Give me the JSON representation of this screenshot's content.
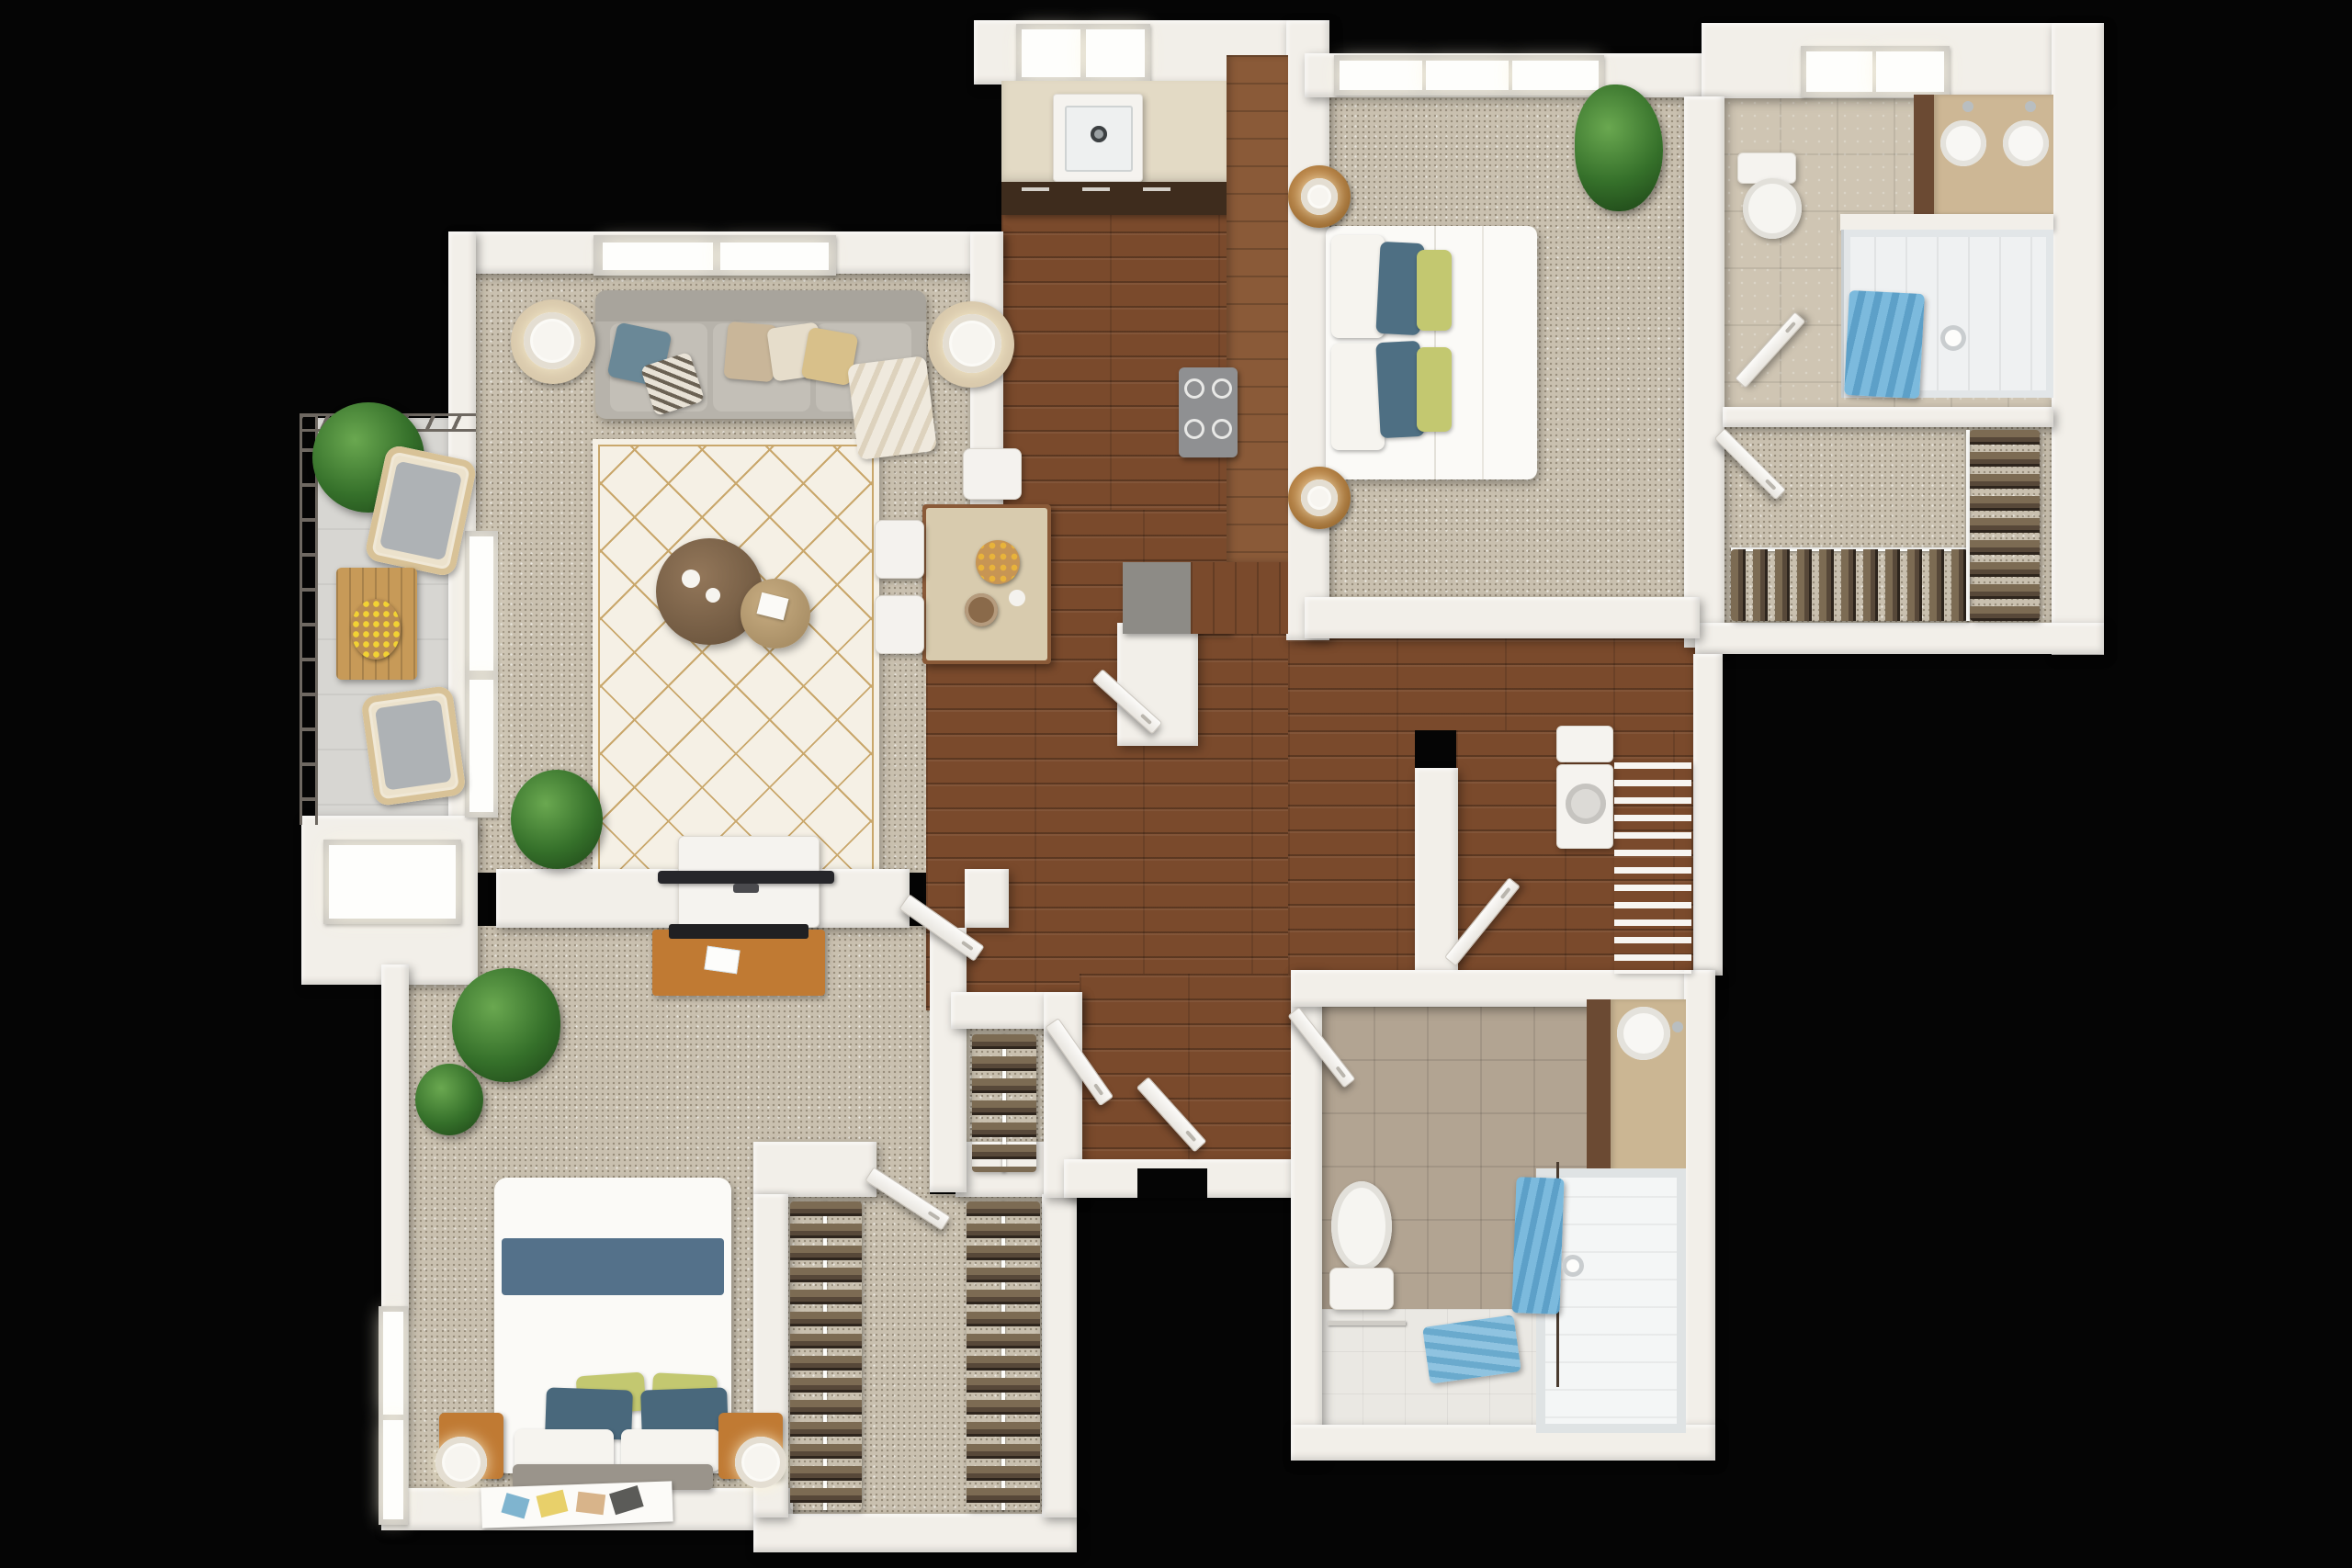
{
  "document": {
    "kind": "3d-floor-plan-rendering",
    "view": "top-down",
    "background": "black",
    "visible_text": []
  },
  "palette": {
    "bg": "#050505",
    "wall": "#f2efe9",
    "carpet": "#c9c0af",
    "wood": "#7a4a2c",
    "wood2": "#8a5a38",
    "woodcab": "#3e2c1d",
    "counter": "#e3dac5",
    "island": "#d8cbae",
    "balcony": "#d7d6d2",
    "tile1": "#cfc5b3",
    "tile2": "#b2a492",
    "whitefloor": "#eae8e3",
    "sofa": "#b7b3ab",
    "rugbase": "#f5f0e5",
    "ruggold": "#c9a76b",
    "blue": "#4e6f83",
    "green": "#c3c870",
    "towel": "#68aed2",
    "furnwood": "#c07a33",
    "graytop": "#8d8b86"
  },
  "rooms": [
    {
      "id": "living-room",
      "name": "Living Room",
      "floor": "carpet",
      "furniture": [
        "sofa",
        "throw-pillows",
        "two-round-side-tables-with-lamps",
        "patterned-area-rug",
        "two-round-coffee-tables",
        "plant",
        "window",
        "tv-on-half-wall"
      ]
    },
    {
      "id": "kitchen",
      "name": "Kitchen",
      "floor": "wood",
      "furniture": [
        "sink",
        "counters",
        "dark-lower-cabinets",
        "cooktop",
        "skylight-window",
        "peninsula"
      ]
    },
    {
      "id": "dining-hall",
      "name": "Dining / Hall",
      "floor": "wood",
      "furniture": [
        "island-with-stools",
        "serving-plates"
      ]
    },
    {
      "id": "balcony",
      "name": "Balcony",
      "floor": "concrete",
      "furniture": [
        "railing",
        "two-wicker-chairs",
        "wood-table-with-lemons",
        "plant"
      ]
    },
    {
      "id": "master-bedroom",
      "name": "Master Bedroom",
      "floor": "carpet",
      "furniture": [
        "queen-bed",
        "blue-green-pillows",
        "two-round-nightstands-with-lamps",
        "palm-plant",
        "window"
      ]
    },
    {
      "id": "master-bathroom",
      "name": "Master Bathroom",
      "floor": "tile",
      "furniture": [
        "toilet",
        "double-sink-vanity",
        "walk-in-shower",
        "blue-towel",
        "skylight-window"
      ]
    },
    {
      "id": "master-closet",
      "name": "Master Walk-in Closet",
      "floor": "carpet",
      "furniture": [
        "hanging-clothes-two-rows",
        "rails"
      ]
    },
    {
      "id": "laundry",
      "name": "Laundry Nook",
      "floor": "wood",
      "furniture": [
        "washer",
        "wire-shelving"
      ]
    },
    {
      "id": "bedroom-2",
      "name": "Bedroom 2",
      "floor": "carpet",
      "furniture": [
        "bed-with-blue-stripe",
        "bench",
        "art-print",
        "two-nightstands-with-lamps",
        "desk-with-monitor",
        "plants",
        "window"
      ]
    },
    {
      "id": "closet-2",
      "name": "Walk-in Closet 2",
      "floor": "carpet",
      "furniture": [
        "hanging-clothes-two-rows"
      ]
    },
    {
      "id": "coat-closet",
      "name": "Coat Closet",
      "floor": "carpet",
      "furniture": [
        "hanging-clothes"
      ]
    },
    {
      "id": "entry-hall",
      "name": "Entry Hall",
      "floor": "wood",
      "furniture": [
        "entry-door",
        "closet-door"
      ]
    },
    {
      "id": "bathroom-2",
      "name": "Bathroom 2",
      "floor": "tile",
      "furniture": [
        "toilet",
        "vanity-with-round-sinks",
        "tub-shower",
        "blue-towel",
        "blue-bath-mat"
      ]
    }
  ]
}
